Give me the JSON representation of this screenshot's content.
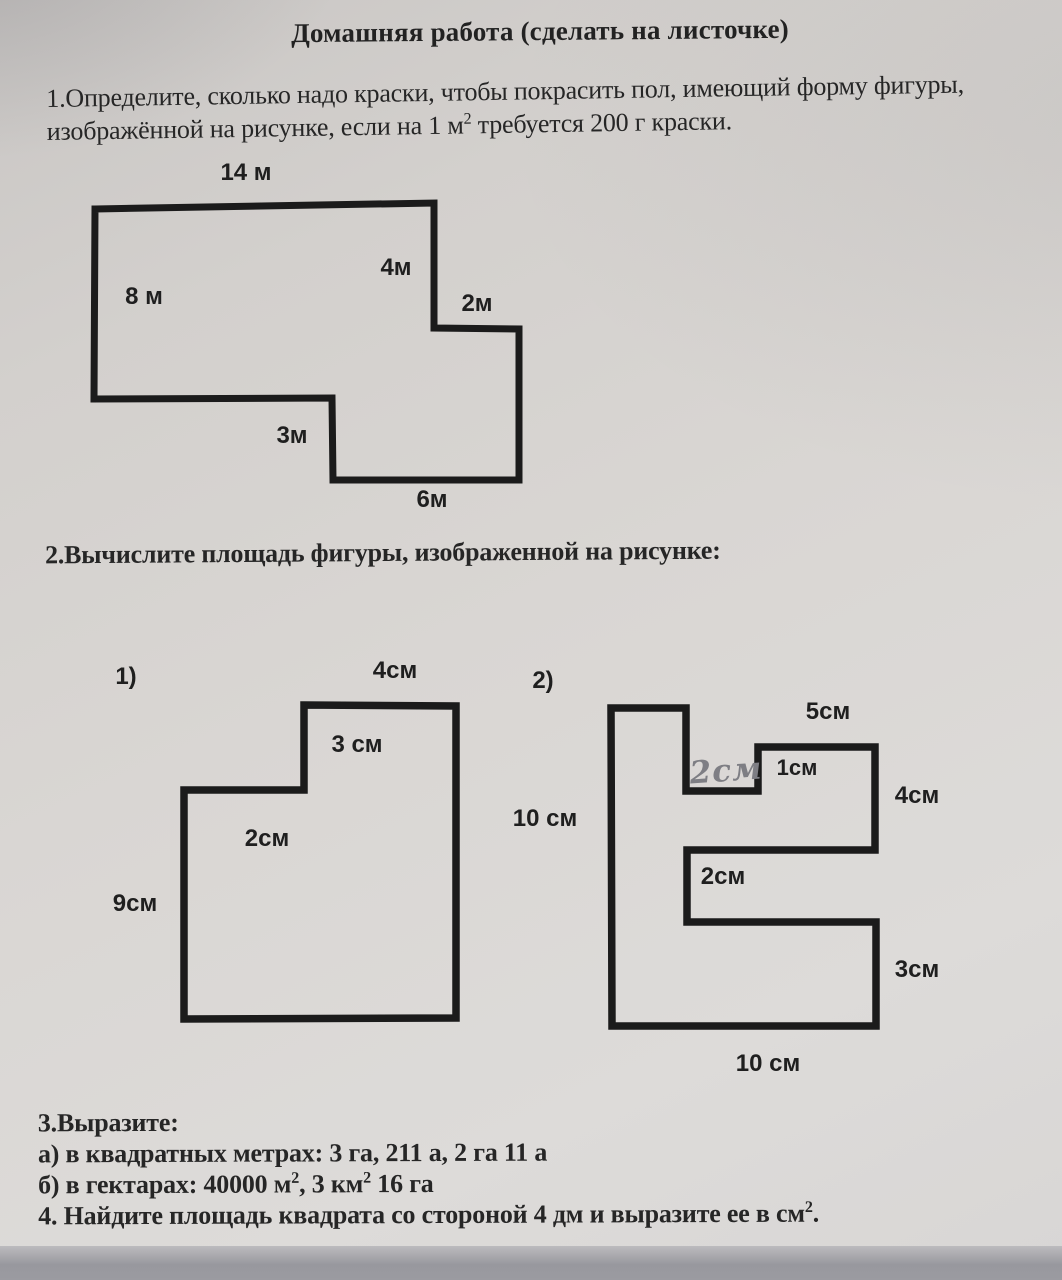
{
  "title": "Домашняя работа (сделать на листочке)",
  "task1": {
    "line1": "1.Определите, сколько надо краски, чтобы покрасить пол, имеющий форму фигуры,",
    "line2": {
      "p1": "изображённой на рисунке, если на 1 м",
      "s1": "2",
      "p2": " требуется 200 г краски."
    }
  },
  "task2": {
    "text": "2.Вычислите площадь фигуры, изображенной на рисунке:"
  },
  "task3": {
    "heading": "3.Выразите:",
    "line_a": "а) в квадратных метрах: 3 га, 211 а, 2 га 11 а",
    "line_b": {
      "p1": "б) в гектарах: 40000 м",
      "s1": "2",
      "p2": ", 3 км",
      "s2": "2",
      "p3": " 16 га"
    }
  },
  "task4": {
    "p1": "4. Найдите площадь квадрата со стороной 4 дм и выразите ее в см",
    "s1": "2",
    "p2": "."
  },
  "figure1": {
    "dim_top": "14 м",
    "dim_left": "8 м",
    "dim_inner_vertical": "4м",
    "dim_step": "2м",
    "dim_notch": "3м",
    "dim_bottom": "6м"
  },
  "figure2_1": {
    "index_label": "1)",
    "dim_top": "4см",
    "dim_inner_vertical": "3 см",
    "dim_inner_horizontal": "2см",
    "dim_left": "9см"
  },
  "figure2_2": {
    "index_label": "2)",
    "dim_top": "5см",
    "dim_handwritten": "2см",
    "dim_step": "1см",
    "dim_right_upper": "4см",
    "dim_left": "10 см",
    "dim_middle": "2см",
    "dim_right_lower": "3см",
    "dim_bottom": "10 см"
  },
  "colors": {
    "ink": "#1b1b1b",
    "paper": "#d7d4d1",
    "handwriting": "#7e7e84"
  }
}
